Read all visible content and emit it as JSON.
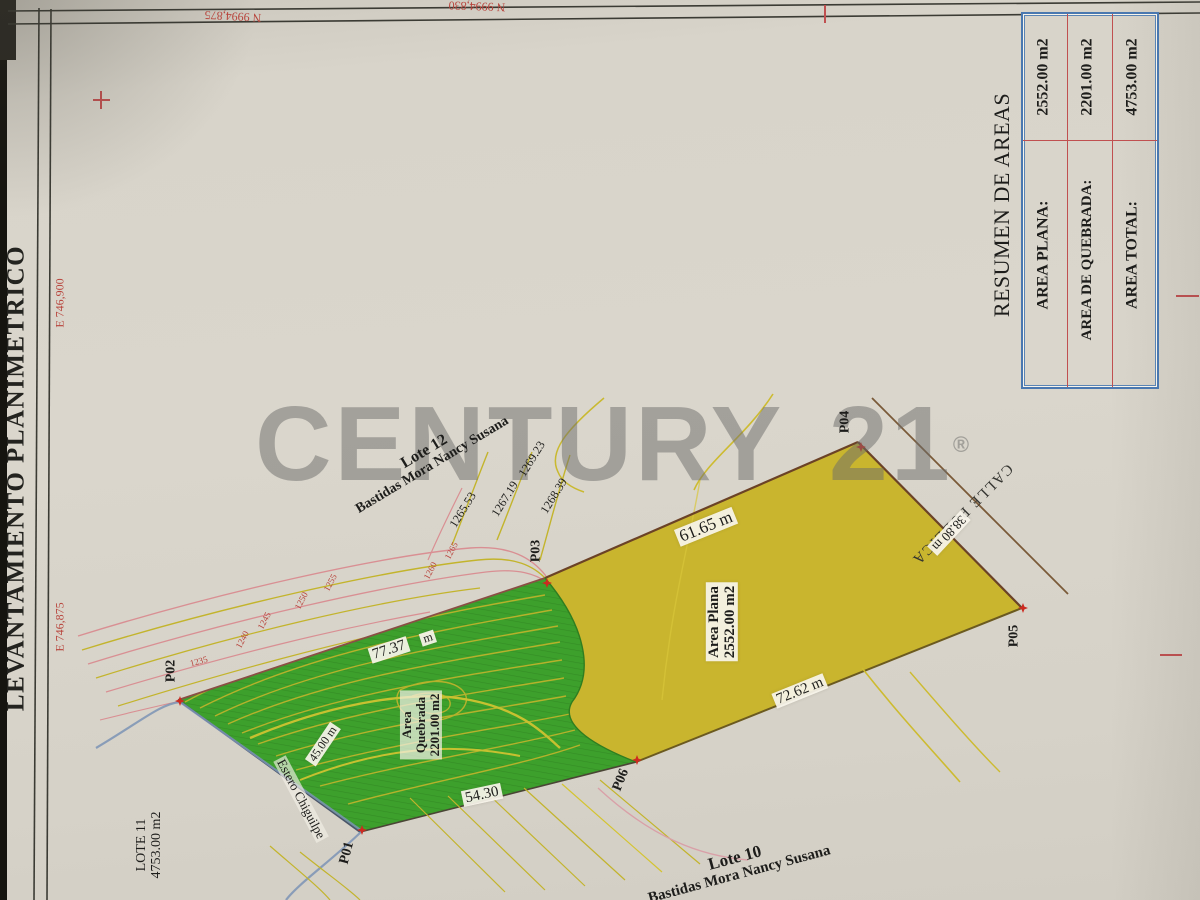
{
  "photo": {
    "watermark": "CENTURY 21",
    "watermark_reg": "®"
  },
  "sheet": {
    "title": "LEVANTAMIENTO PLANIMETRICO",
    "grid_labels": {
      "n1": "N 9994,875",
      "n2": "N 9994,830",
      "e1": "E 746,900",
      "e2": "E 746,875"
    }
  },
  "areas_table": {
    "title": "RESUMEN DE AREAS",
    "rows": [
      {
        "label": "AREA PLANA:",
        "value": "2552.00 m2"
      },
      {
        "label": "AREA DE QUEBRADA:",
        "value": "2201.00 m2"
      },
      {
        "label": "AREA TOTAL:",
        "value": "4753.00 m2"
      }
    ]
  },
  "map": {
    "lots": {
      "lote12": {
        "name": "Lote 12",
        "owner": "Bastidas Mora Nancy Susana"
      },
      "lote10": {
        "name": "Lote 10",
        "owner": "Bastidas Mora Nancy Susana"
      },
      "lote11": {
        "name": "LOTE 11",
        "area": "4753.00 m2"
      }
    },
    "zones": {
      "area_plana": {
        "line1": "Area Plana",
        "line2": "2552.00 m2"
      },
      "area_quebrada": {
        "line1": "Area",
        "line2": "Quebrada",
        "line3": "2201.00 m2"
      }
    },
    "road_name": "CALLE PUBLICA",
    "stream_name": "Estero Chiguilpe",
    "measurements": {
      "p03_p04": "61.65 m",
      "p04_p05": "38.80 m",
      "p06_p05": "72.62 m",
      "p01_p06": "54.30",
      "p02_p03": "77.37",
      "p02_p03_unit": "m",
      "p01_p02": "45.00 m"
    },
    "points": [
      "P01",
      "P02",
      "P03",
      "P04",
      "P05",
      "P06"
    ],
    "elevations_black": [
      "1265.53",
      "1267.19",
      "1268.39",
      "1269.23"
    ],
    "elevations_red": [
      "1235",
      "1240",
      "1245",
      "1250",
      "1255",
      "1260",
      "1265"
    ]
  },
  "colors": {
    "paper": "#d9d5cb",
    "quebrada_green": "#3da02c",
    "plana_yellow": "#c9b52e",
    "survey_point_red": "#cc2a20",
    "grid_red": "#c05050",
    "table_border_blue": "#4a78b0",
    "watermark_gray": "#6c6c6a",
    "contour_olive": "#c3b42c",
    "contour_pink": "#d98f93",
    "stream_blue": "#7b93b5"
  }
}
